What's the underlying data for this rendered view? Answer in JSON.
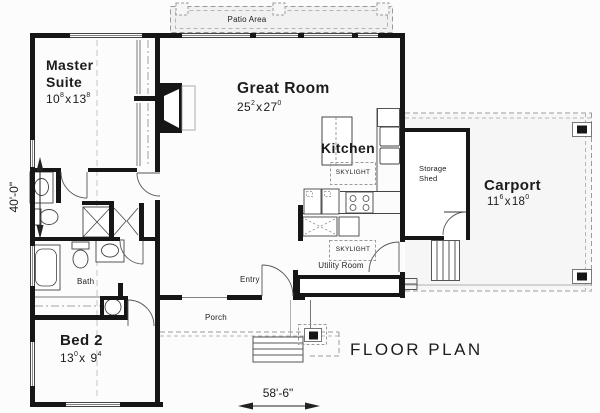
{
  "page": {
    "title": "FLOOR PLAN"
  },
  "labels": {
    "patio": "Patio Area",
    "porch": "Porch",
    "entry": "Entry",
    "bath": "Bath",
    "utility_room": "Utility Room",
    "storage_line1": "Storage",
    "storage_line2": "Shed",
    "kitchen": "Kitchen",
    "skylight_kitchen": "SKYLIGHT",
    "skylight_utility": "SKYLIGHT"
  },
  "rooms": {
    "master": {
      "line1": "Master",
      "line2": "Suite",
      "dim": {
        "w": "10",
        "wsup": "8",
        "sep": "x",
        "h": "13",
        "hsup": "8"
      }
    },
    "great": {
      "name": "Great Room",
      "dim": {
        "w": "25",
        "wsup": "2",
        "sep": "x",
        "h": "27",
        "hsup": "0"
      }
    },
    "bed2": {
      "name": "Bed 2",
      "dim": {
        "w": "13",
        "wsup": "0",
        "sep": "x",
        "h": "9",
        "hsup": "4"
      }
    },
    "carport": {
      "name": "Carport",
      "dim": {
        "w": "11",
        "wsup": "6",
        "sep": "x",
        "h": "18",
        "hsup": "0"
      }
    }
  },
  "dimensions": {
    "overall_width": "58'-6\"",
    "overall_height": "40'-0\""
  },
  "colors": {
    "wall": "#161616",
    "line": "#444444",
    "dash": "#9a9a9a",
    "patio_fill": "#f1f1f1",
    "carport_fill": "#f6f6f6"
  }
}
